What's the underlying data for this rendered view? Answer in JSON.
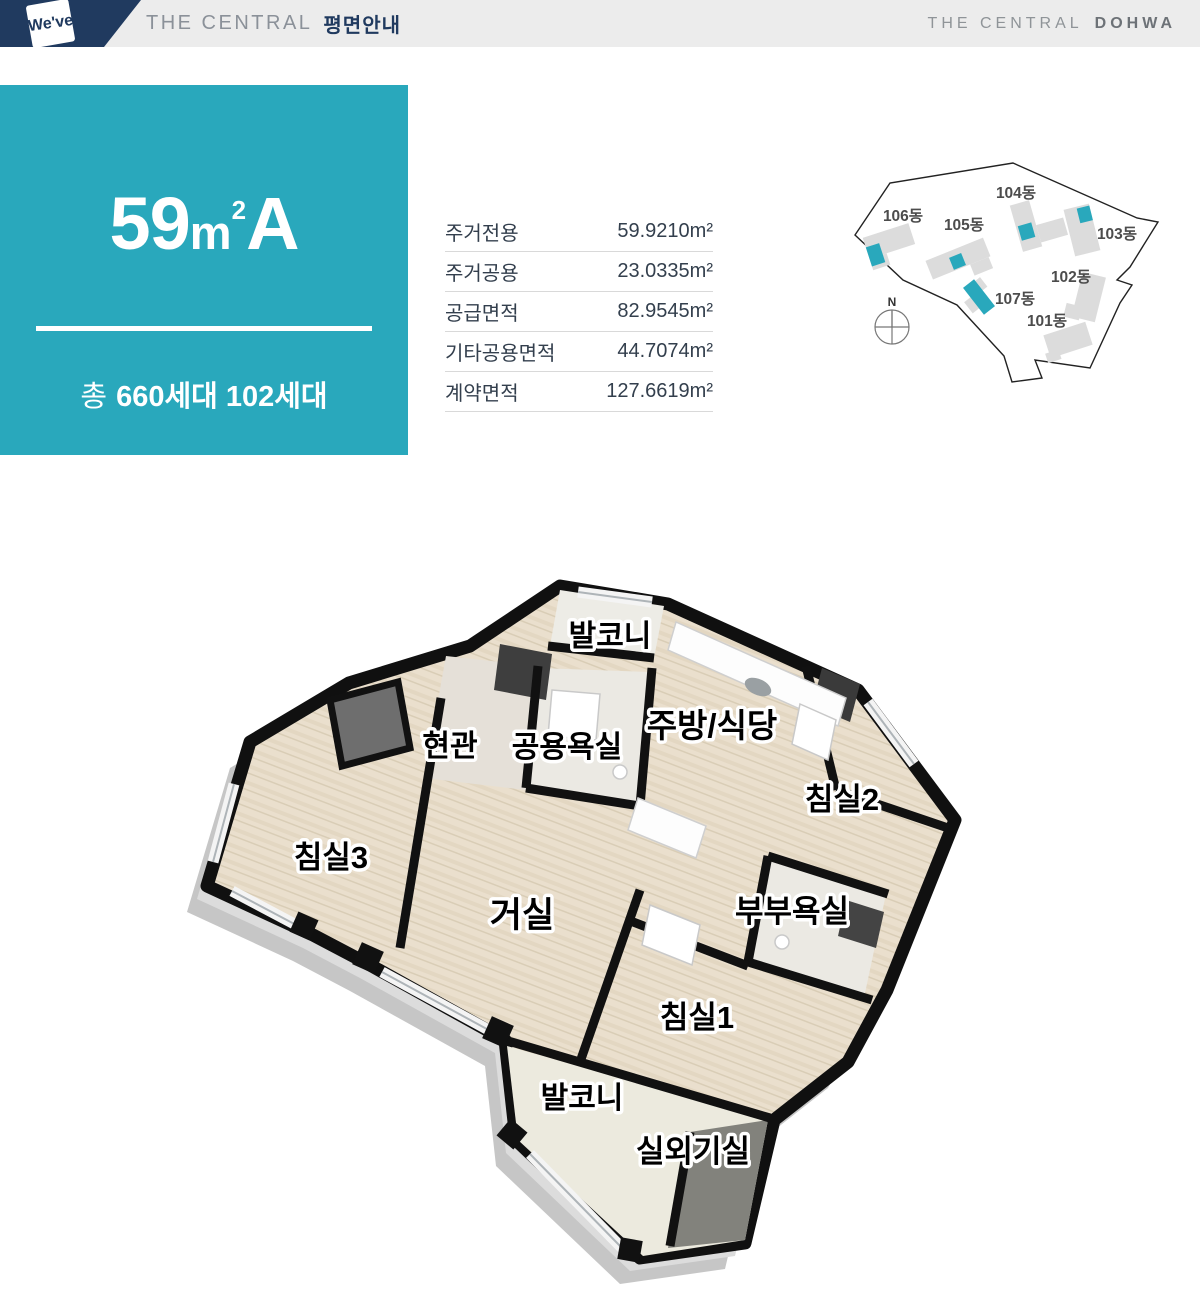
{
  "header": {
    "logo": "We've",
    "left_brand": "THE CENTRAL",
    "left_section": "평면안내",
    "right_brand": "THE CENTRAL",
    "right_brand_bold": "DOHWA"
  },
  "unit": {
    "size_number": "59",
    "size_unit": "m",
    "size_sup": "2",
    "type_suffix": "A",
    "households_prefix": "총",
    "households_bold": "660세대 102세대",
    "accent_color": "#29a8bc",
    "navy_color": "#203a5f"
  },
  "area_table": {
    "rows": [
      {
        "label": "주거전용",
        "value": "59.9210m²"
      },
      {
        "label": "주거공용",
        "value": "23.0335m²"
      },
      {
        "label": "공급면적",
        "value": "82.9545m²"
      },
      {
        "label": "기타공용면적",
        "value": "44.7074m²"
      },
      {
        "label": "계약면적",
        "value": "127.6619m²"
      }
    ]
  },
  "site_map": {
    "north": "N",
    "highlight_color": "#29a8bc",
    "buildings": [
      {
        "label": "101동"
      },
      {
        "label": "102동"
      },
      {
        "label": "103동"
      },
      {
        "label": "104동"
      },
      {
        "label": "105동"
      },
      {
        "label": "106동"
      },
      {
        "label": "107동"
      }
    ]
  },
  "floor_plan": {
    "rooms": [
      {
        "label": "발코니"
      },
      {
        "label": "현관"
      },
      {
        "label": "공용욕실"
      },
      {
        "label": "주방/식당"
      },
      {
        "label": "침실2"
      },
      {
        "label": "침실3"
      },
      {
        "label": "거실"
      },
      {
        "label": "부부욕실"
      },
      {
        "label": "침실1"
      },
      {
        "label": "발코니"
      },
      {
        "label": "실외기실"
      }
    ]
  }
}
